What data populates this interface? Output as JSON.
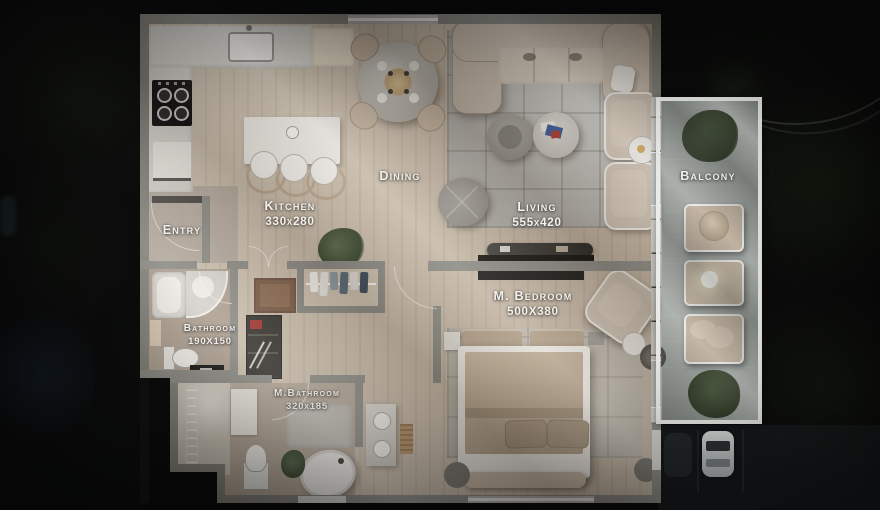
{
  "scene": {
    "type": "apartment-floor-plan-top-down-render",
    "time_of_day": "night-aerial-background"
  },
  "palette": {
    "bg": "#0b0b0c",
    "wall": "#8b8b85",
    "wall_dark": "#83837d",
    "floor_wood": "#c9bcab",
    "floor_gray": "#b3aa9f",
    "counter": "#d8d6d1",
    "island": "#eae8e3",
    "rug": "#b7b5b0",
    "sofa": "#c8bcae",
    "tan": "#c2b19e",
    "white_fixture": "#efede9",
    "balcony_floor": "#a6aba7",
    "railing": "#ebebe7",
    "window": "#e9e9e5",
    "dark_furniture": "#1d1c1a",
    "green_plant": "#4e5c41",
    "label_text": "#f3f2ef"
  },
  "rooms": {
    "entry": {
      "name": "Entry"
    },
    "kitchen": {
      "name": "Kitchen",
      "dims": "330x280"
    },
    "dining": {
      "name": "Dining"
    },
    "living": {
      "name": "Living",
      "dims": "555x420"
    },
    "balcony": {
      "name": "Balcony"
    },
    "bathroom": {
      "name": "Bathroom",
      "dims": "190X150"
    },
    "m_bathroom": {
      "name": "M.Bathroom",
      "dims": "320x185"
    },
    "m_bedroom": {
      "name": "M. Bedroom",
      "dims": "500X380"
    }
  }
}
